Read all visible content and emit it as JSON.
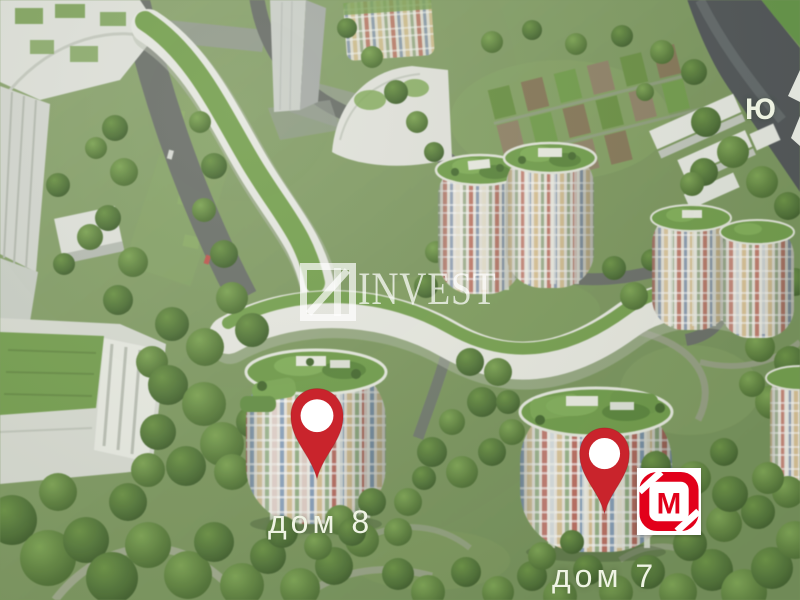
{
  "scene": {
    "type": "aerial-3d-masterplan",
    "description": "Bird's-eye 3D render of a residential complex: white serpentine buildings with green roofs, colorful round towers, roads, garden plots and dense trees"
  },
  "watermark": {
    "logo_icon": "square-4-logo",
    "text": "INVEST",
    "color": "#ffffff"
  },
  "compass": {
    "south_label": "Ю",
    "arrow_icon": "compass-arrow"
  },
  "markers": [
    {
      "id": "dom-8",
      "label": "дом 8",
      "pin_icon": "map-pin",
      "pin_color": "#c9242c"
    },
    {
      "id": "dom-7",
      "label": "дом 7",
      "pin_icon": "map-pin",
      "pin_color": "#c9242c"
    }
  ],
  "store_badge": {
    "icon": "magnit-logo",
    "letter": "М",
    "brand_color": "#e2001a",
    "background": "#ffffff"
  },
  "palette": {
    "grass": "#7e9a60",
    "trees_dark": "#47682f",
    "road_grey": "#70756d",
    "river_road": "#54595b",
    "building_white": "#e6e8e0",
    "roof_green": "#74a14d",
    "label_text": "#eff4e4"
  }
}
